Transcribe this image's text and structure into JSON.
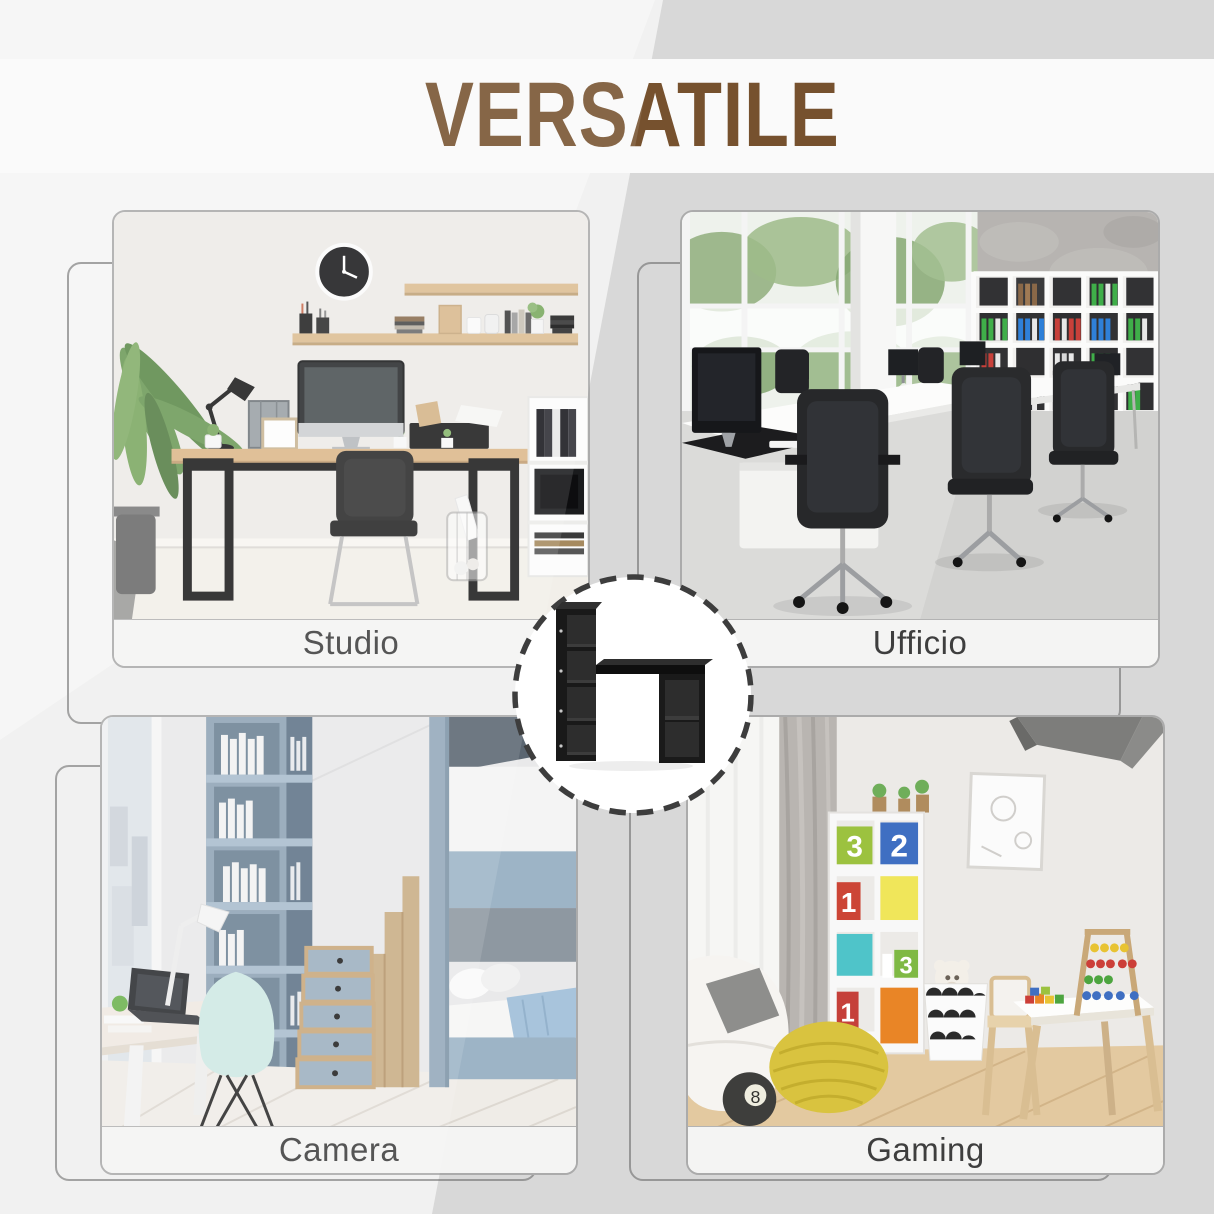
{
  "header": {
    "title": "VERSATILE",
    "title_color": "#76512E"
  },
  "background": {
    "base": "#d8d8d8",
    "light_diagonal": "#f0f0ef",
    "title_band": "#fafafa"
  },
  "badge": {
    "border_color": "#3d3d3d",
    "fill": "#ffffff",
    "product_icon": "black-desk-with-bookshelf-icon"
  },
  "cards": [
    {
      "id": "studio",
      "label": "Studio"
    },
    {
      "id": "ufficio",
      "label": "Ufficio"
    },
    {
      "id": "camera",
      "label": "Camera"
    },
    {
      "id": "gaming",
      "label": "Gaming"
    }
  ],
  "gaming_photo": {
    "box_labels": [
      "3",
      "2",
      "1",
      "3",
      "1"
    ],
    "ball_label": "8"
  }
}
